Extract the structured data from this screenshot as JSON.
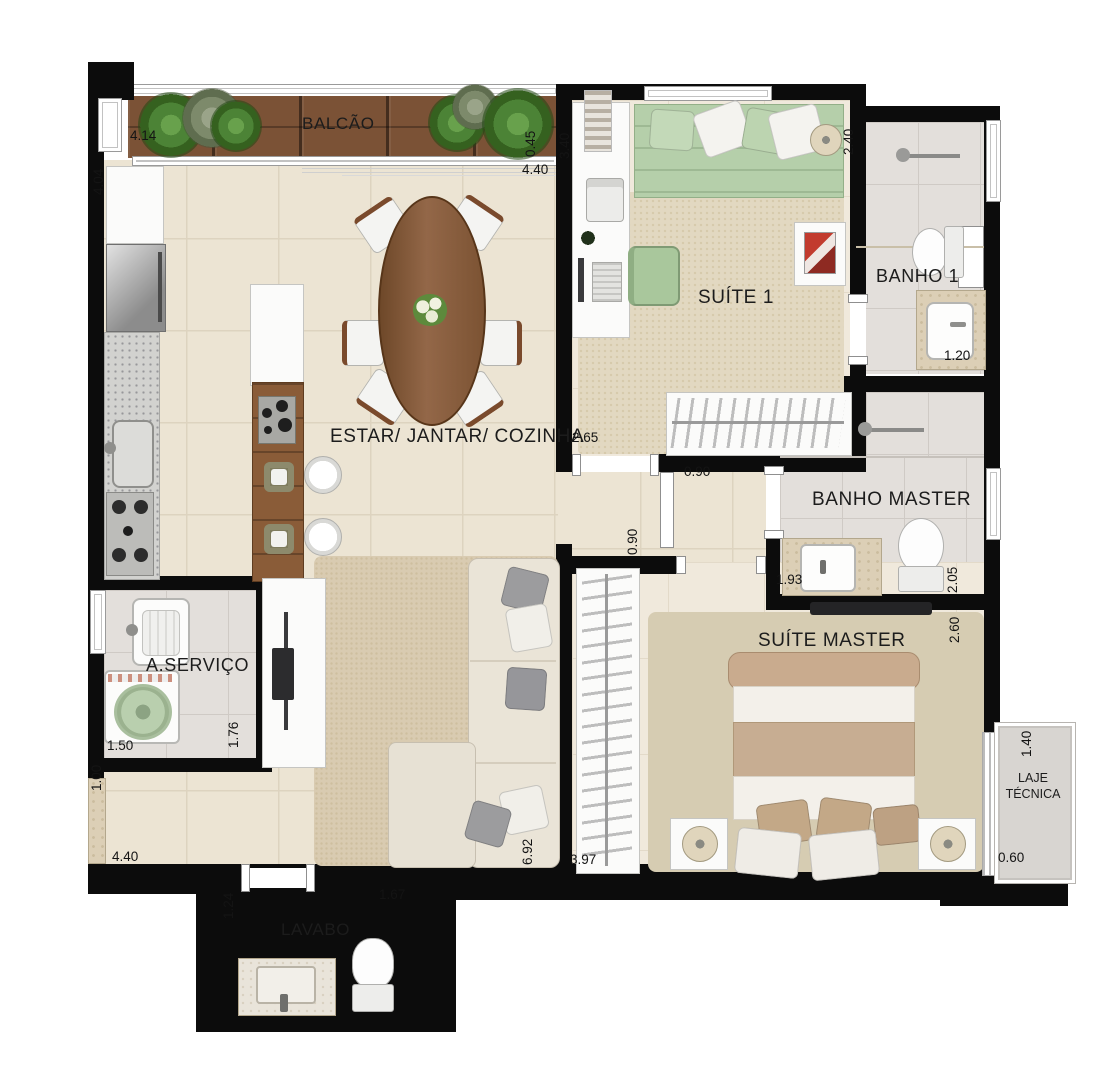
{
  "plan": {
    "type": "apartment-floor-plan",
    "rooms": {
      "balcao": {
        "label": "BALCÃO"
      },
      "estar": {
        "label": "ESTAR/ JANTAR/ COZINHA"
      },
      "suite1": {
        "label": "SUÍTE 1"
      },
      "banho1": {
        "label": "BANHO 1"
      },
      "banho_master": {
        "label": "BANHO MASTER"
      },
      "aservico": {
        "label": "A.SERVIÇO"
      },
      "suite_master": {
        "label": "SUÍTE MASTER"
      },
      "laje": {
        "label_line1": "LAJE",
        "label_line2": "TÉCNICA"
      },
      "lavabo": {
        "label": "LAVABO"
      }
    },
    "dims": {
      "balcony_length": "4.14",
      "balcony_depth": "0.45",
      "suite1_width": "3.40",
      "kitchen_length": "4.04",
      "living_width_top": "4.40",
      "banho1_depth": "2.40",
      "banho1_width": "1.20",
      "suite1_door_wall": "2.65",
      "hall_door": "0.90",
      "hall_width": "0.90",
      "banho_master_counter": "1.93",
      "banho_master_depth": "2.05",
      "suite_master_depth": "2.60",
      "servico_width": "1.50",
      "servico_depth": "1.76",
      "living_opening": "1.00",
      "living_width_bottom": "4.40",
      "living_length": "6.92",
      "suite_master_width": "3.97",
      "laje_depth": "1.40",
      "laje_width": "0.60",
      "lavabo_width": "1.24",
      "lavabo_length": "1.67"
    },
    "colors": {
      "wall": "#0c0c0c",
      "floor_living": "#ece4d3",
      "floor_bath": "#e3dfdb",
      "balcony_wood": "#7b5236",
      "suite1_bed_green": "#b5cfaa",
      "master_bed_tan": "#c7ad92",
      "text": "#1c1c1c"
    },
    "icons": {
      "shower-icon": "rod-with-head-circle",
      "toilet-icon": "ellipse-bowl-plus-tank",
      "sink-icon": "rounded-basin",
      "washer-icon": "square-with-drum-circle",
      "cooktop-icon": "grid-of-burner-dots",
      "hanger-rail-icon": "striped-rail",
      "plant-icon": "radial-green-circle",
      "lamp-icon": "shaded-circle",
      "tv-icon": "dark-bar",
      "flowers-icon": "dot-cluster"
    }
  }
}
